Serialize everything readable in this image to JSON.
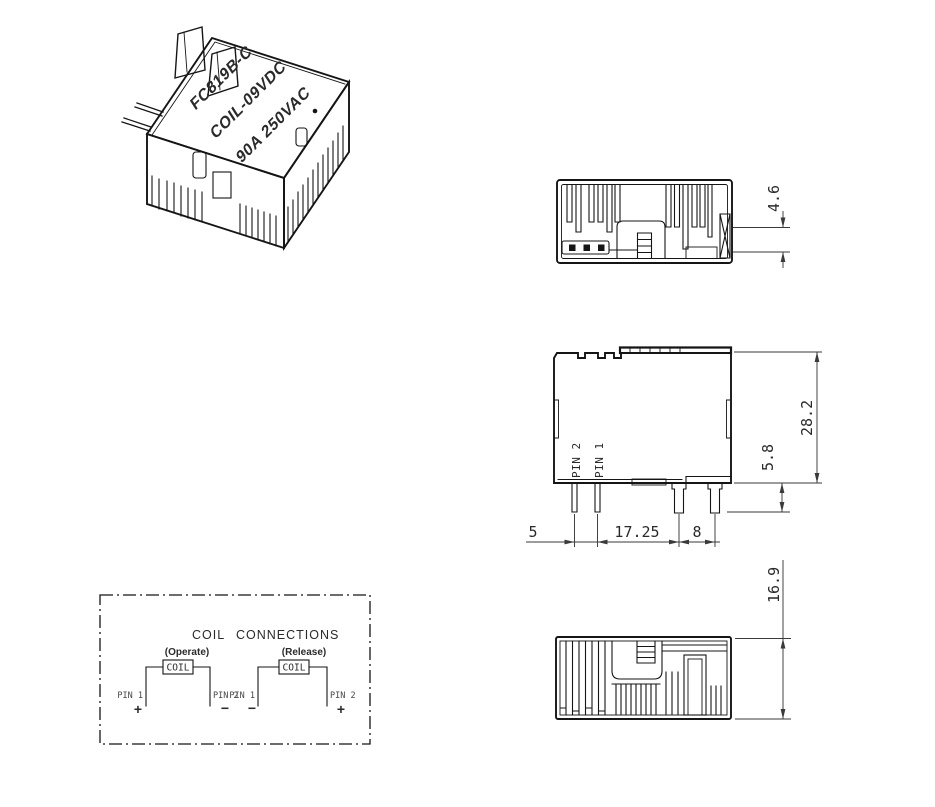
{
  "product_label": {
    "model": "FC819B-C",
    "coil": "COIL-09VDC",
    "rating": "90A 250VAC"
  },
  "top_view": {
    "dim_height": "4.6"
  },
  "side_view": {
    "pin2": "PIN 2",
    "pin1": "PIN 1",
    "dim_body_height": "28.2",
    "dim_pin_length": "5.8",
    "dim_coil_pin_pitch": "5",
    "dim_coil_to_load_pitch": "17.25",
    "dim_load_pin_pitch": "8"
  },
  "bottom_view": {
    "dim_body_width": "16.9"
  },
  "coil_connections": {
    "title_word1": "COIL",
    "title_word2": "CONNECTIONS",
    "operate": {
      "caption": "(Operate)",
      "coil_label": "COIL",
      "left_pin": "PIN 1",
      "left_polarity": "+",
      "right_pin": "PIN 2",
      "right_polarity": "−"
    },
    "release": {
      "caption": "(Release)",
      "coil_label": "COIL",
      "left_pin": "PIN 1",
      "left_polarity": "−",
      "right_pin": "PIN 2",
      "right_polarity": "+"
    }
  },
  "colors": {
    "line": "#151515",
    "dim": "#3a3a3a",
    "text": "#2a2a2a",
    "background": "#ffffff"
  }
}
